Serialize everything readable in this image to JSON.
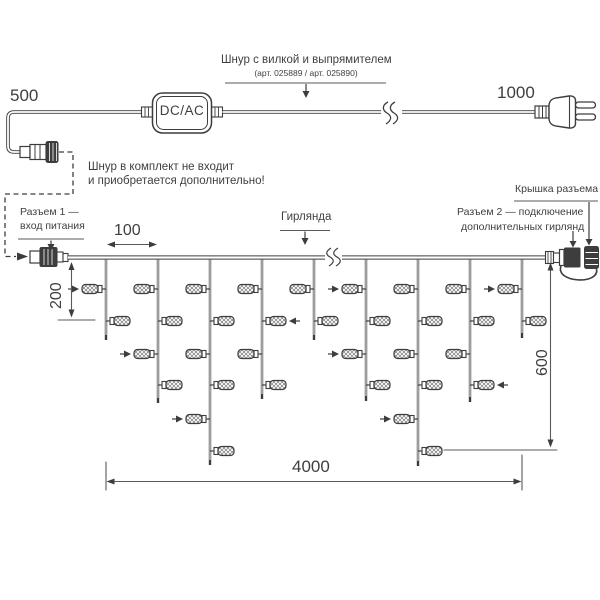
{
  "labels": {
    "dim_500": "500",
    "dim_1000": "1000",
    "dim_100": "100",
    "dim_200": "200",
    "dim_600": "600",
    "dim_4000": "4000",
    "dcac": "DC/AC",
    "cord_title": "Шнур с вилкой и выпрямителем",
    "cord_articles": "(арт. 025889 / арт. 025890)",
    "note_line1": "Шнур в комплект не входит",
    "note_line2": "и приобретается дополнительно!",
    "connector1_line1": "Разъем 1 —",
    "connector1_line2": "вход питания",
    "garland_label": "Гирлянда",
    "cap_label": "Крышка разъема",
    "connector2_line1": "Разъем 2 — подключение",
    "connector2_line2": "дополнительных гирлянд"
  },
  "colors": {
    "line": "#3d3d3d",
    "dim": "#5a5a5a",
    "text": "#3f3f3f",
    "background": "#ffffff"
  },
  "garland": {
    "wire_y": 257.5,
    "row_y": [
      289,
      321,
      354,
      385,
      419,
      451
    ],
    "drops": [
      {
        "x": 106,
        "tip": 340,
        "lamps": [
          {
            "row": 0,
            "side": "left",
            "arrow": true
          },
          {
            "row": 1,
            "side": "right",
            "arrow": false
          }
        ]
      },
      {
        "x": 158,
        "tip": 403,
        "lamps": [
          {
            "row": 0,
            "side": "left",
            "arrow": false
          },
          {
            "row": 1,
            "side": "right",
            "arrow": false
          },
          {
            "row": 2,
            "side": "left",
            "arrow": true
          },
          {
            "row": 3,
            "side": "right",
            "arrow": false
          }
        ]
      },
      {
        "x": 210,
        "tip": 465,
        "lamps": [
          {
            "row": 0,
            "side": "left",
            "arrow": false
          },
          {
            "row": 1,
            "side": "right",
            "arrow": false
          },
          {
            "row": 2,
            "side": "left",
            "arrow": false
          },
          {
            "row": 3,
            "side": "right",
            "arrow": false
          },
          {
            "row": 4,
            "side": "left",
            "arrow": true
          },
          {
            "row": 5,
            "side": "right",
            "arrow": false
          }
        ]
      },
      {
        "x": 262,
        "tip": 399,
        "lamps": [
          {
            "row": 0,
            "side": "left",
            "arrow": false
          },
          {
            "row": 1,
            "side": "right",
            "arrow": true
          },
          {
            "row": 2,
            "side": "left",
            "arrow": false
          },
          {
            "row": 3,
            "side": "right",
            "arrow": false
          }
        ]
      },
      {
        "x": 314,
        "tip": 340,
        "lamps": [
          {
            "row": 0,
            "side": "left",
            "arrow": false
          },
          {
            "row": 1,
            "side": "right",
            "arrow": false
          }
        ]
      },
      {
        "x": 366,
        "tip": 401,
        "lamps": [
          {
            "row": 0,
            "side": "left",
            "arrow": true
          },
          {
            "row": 1,
            "side": "right",
            "arrow": false
          },
          {
            "row": 2,
            "side": "left",
            "arrow": true
          },
          {
            "row": 3,
            "side": "right",
            "arrow": false
          }
        ]
      },
      {
        "x": 418,
        "tip": 466,
        "lamps": [
          {
            "row": 0,
            "side": "left",
            "arrow": false
          },
          {
            "row": 1,
            "side": "right",
            "arrow": false
          },
          {
            "row": 2,
            "side": "left",
            "arrow": false
          },
          {
            "row": 3,
            "side": "right",
            "arrow": false
          },
          {
            "row": 4,
            "side": "left",
            "arrow": true
          },
          {
            "row": 5,
            "side": "right",
            "arrow": false
          }
        ]
      },
      {
        "x": 470,
        "tip": 402,
        "lamps": [
          {
            "row": 0,
            "side": "left",
            "arrow": false
          },
          {
            "row": 1,
            "side": "right",
            "arrow": false
          },
          {
            "row": 2,
            "side": "left",
            "arrow": false
          },
          {
            "row": 3,
            "side": "right",
            "arrow": true
          }
        ]
      },
      {
        "x": 522,
        "tip": 338,
        "lamps": [
          {
            "row": 0,
            "side": "left",
            "arrow": true
          },
          {
            "row": 1,
            "side": "right",
            "arrow": false
          }
        ]
      }
    ]
  }
}
